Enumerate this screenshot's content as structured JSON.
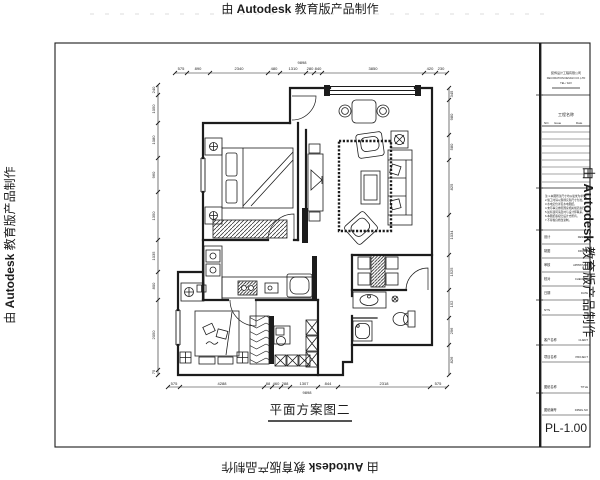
{
  "watermark": {
    "prefix": "由 ",
    "brand": "Autodesk",
    "suffix": " 教育版产品制作"
  },
  "plan_label": "平面方案图二",
  "title_block": {
    "company_lines": [
      "装饰设计工程有限公司",
      "DECORATION DESIGN CO.,LTD",
      "TEL / FAX"
    ],
    "project_header": "工程名称",
    "revision_table": {
      "no": "NO.",
      "issue": "Issue",
      "date": "Date"
    },
    "notes_lines": [
      "注:1.本图所注尺寸均以毫米为单位。",
      "2.施工时请以现场实际尺寸为准。",
      "3.水电定位详见水电图纸。",
      "4.未尽事宜参照国家相关规范执行。",
      "5.如有疑问请及时与设计师联系。",
      "6.本图纸版权归设计方所有。",
      "7.不得擅自修改复制。"
    ],
    "sign_rows": [
      {
        "cn": "设计",
        "en": "DESIGN"
      },
      {
        "cn": "制图",
        "en": "DRAWN"
      },
      {
        "cn": "审核",
        "en": "APPROVED"
      },
      {
        "cn": "校对",
        "en": "CHECKED"
      },
      {
        "cn": "日期",
        "en": "DATE"
      }
    ],
    "scale_note": "NTS",
    "client": {
      "cn": "客户名称",
      "en": "CLIENT"
    },
    "project": {
      "cn": "项目名称",
      "en": "PROJECT"
    },
    "sheet_title": {
      "cn": "图纸名称",
      "en": "TITLE"
    },
    "drawing_no": {
      "cn": "图纸编号",
      "en": "DRWG.NO"
    },
    "sheet_no": "PL-1.00"
  },
  "dims": {
    "top": [
      "575",
      "890",
      "2340",
      "480",
      "1310",
      "280",
      "840",
      "3850",
      "420",
      "230"
    ],
    "top_total": "9898",
    "bottom": [
      "575",
      "4288",
      "88",
      "460",
      "288",
      "1307",
      "844",
      "2318",
      "575"
    ],
    "bottom_total": "9898",
    "left": [
      "240",
      "1050",
      "1080",
      "960",
      "1350",
      "1035",
      "800",
      "2050",
      "75"
    ],
    "right": [
      "345",
      "980",
      "580",
      "825",
      "1034",
      "1525",
      "152",
      "296",
      "826"
    ]
  }
}
